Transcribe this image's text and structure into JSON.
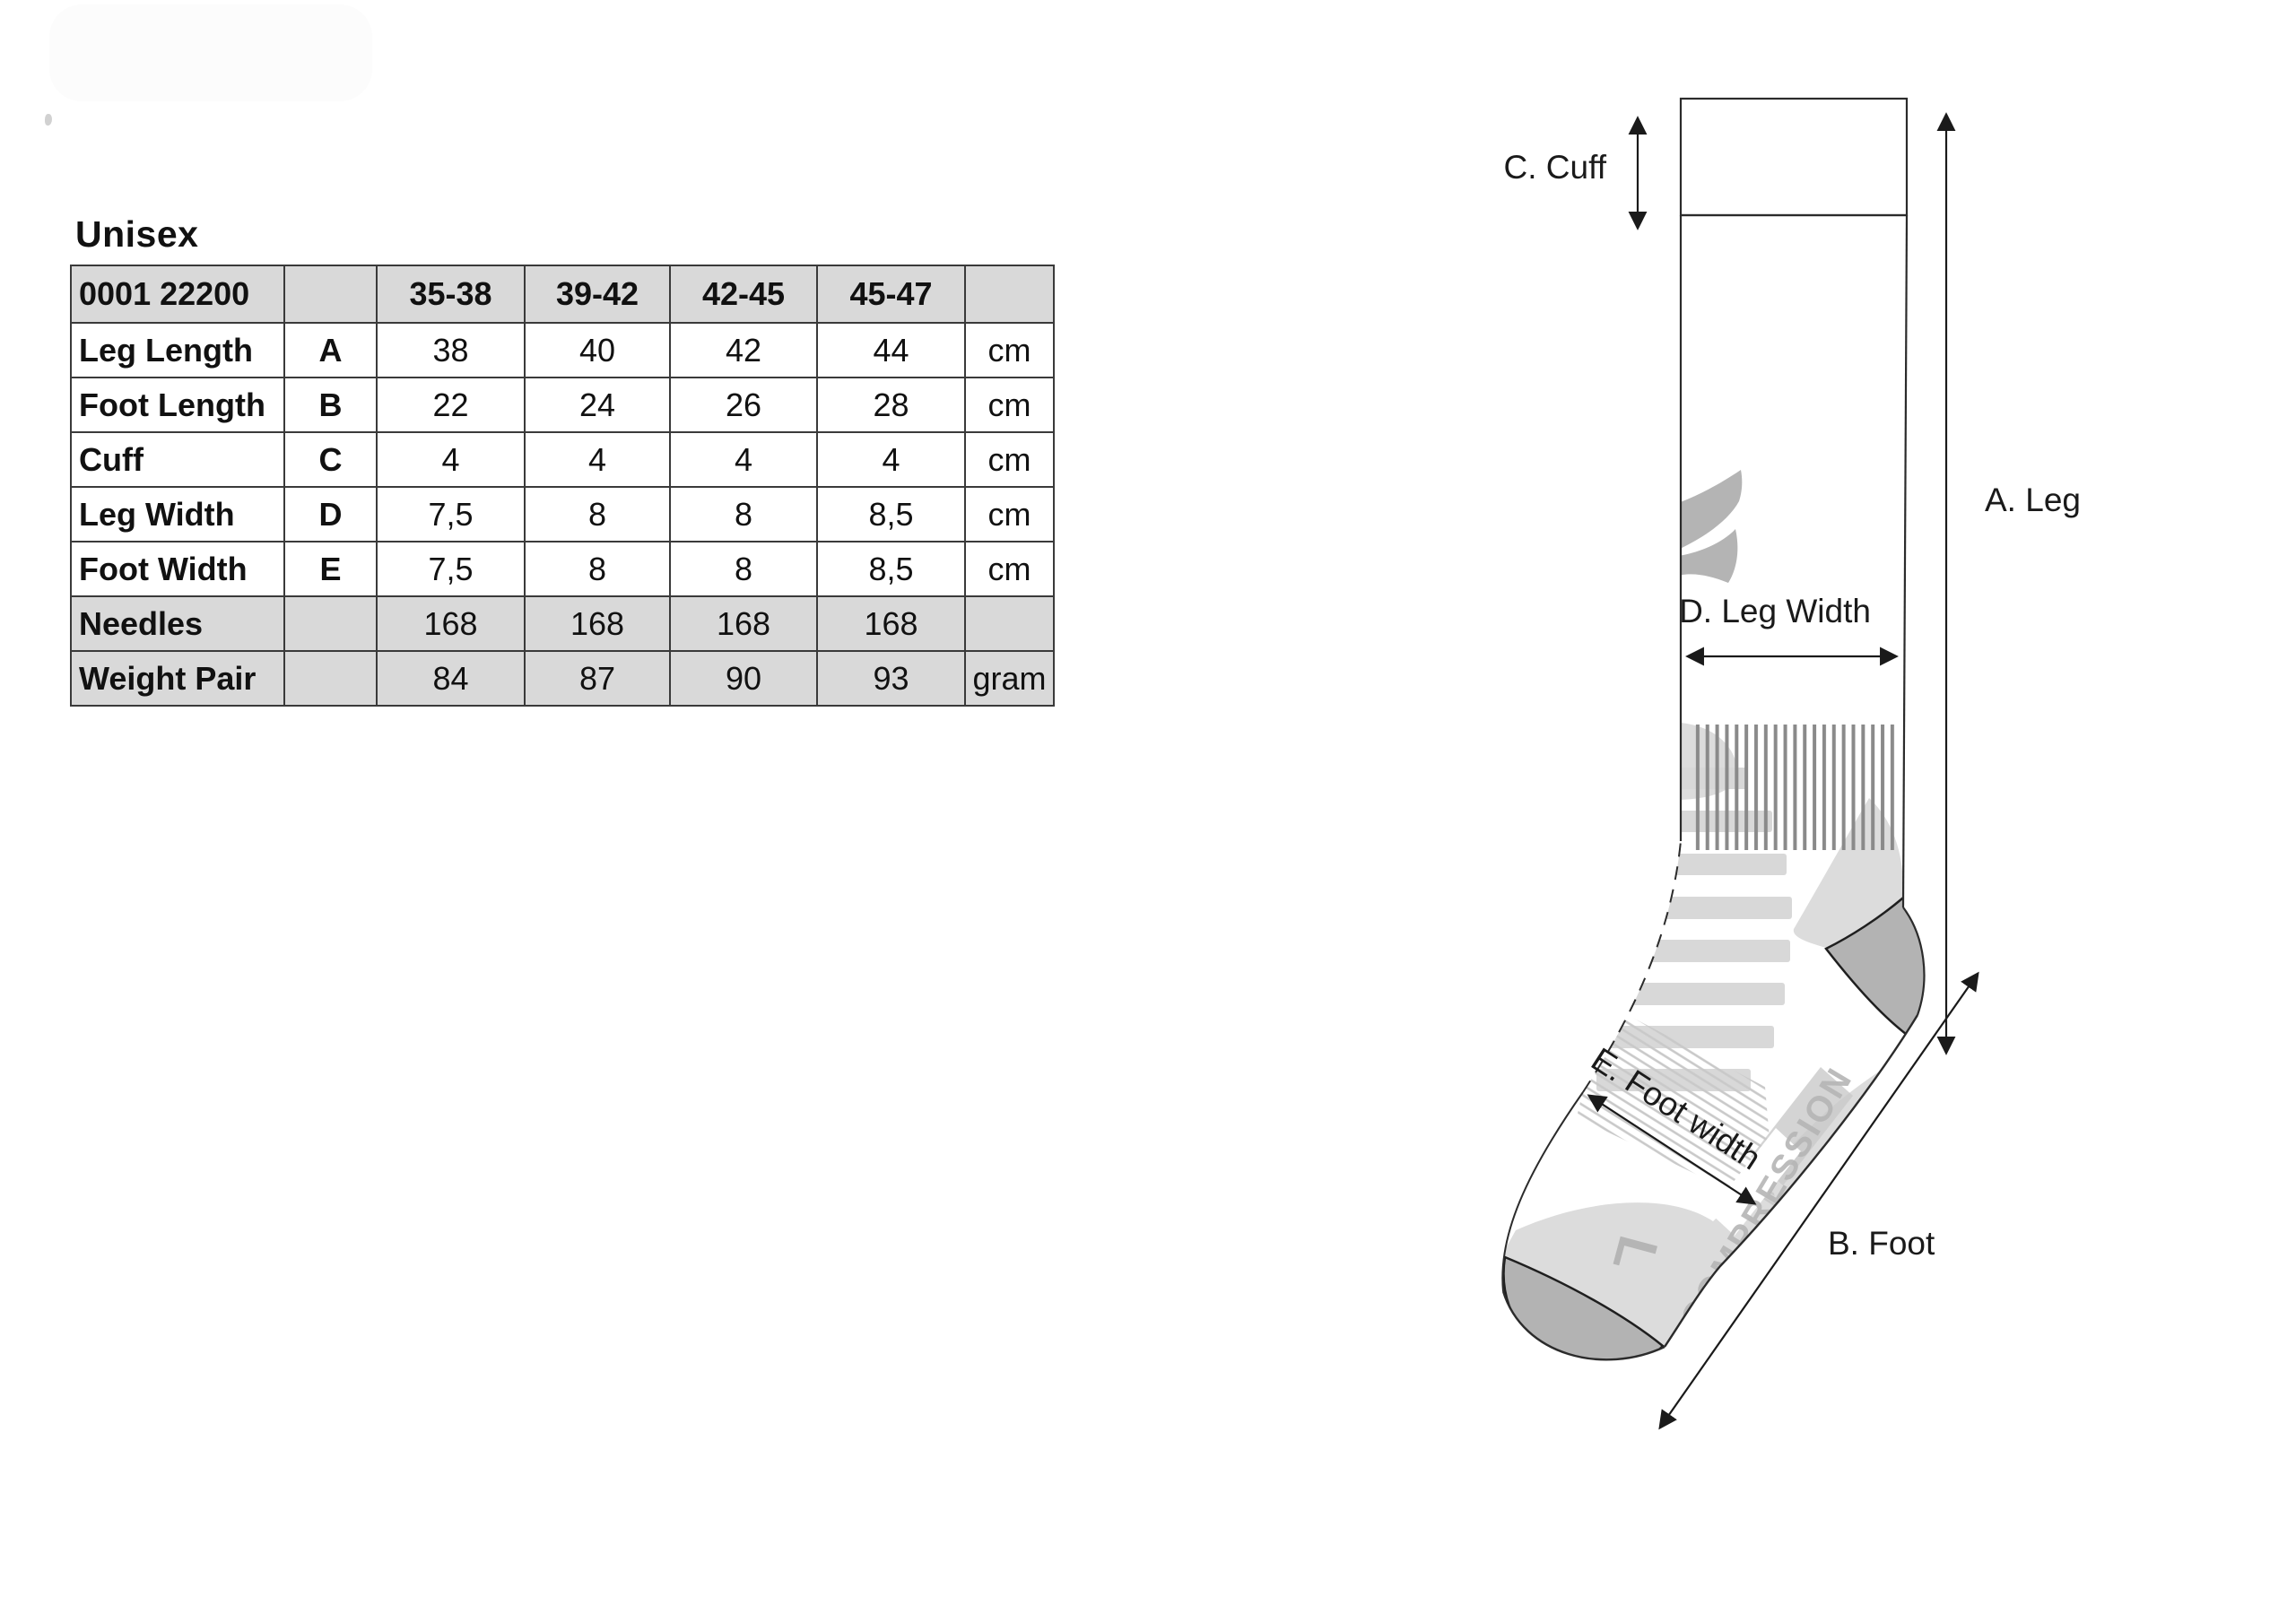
{
  "title": "Unisex",
  "table": {
    "header": [
      "0001 22200",
      "",
      "35-38",
      "39-42",
      "42-45",
      "45-47",
      ""
    ],
    "rows": [
      {
        "label": "Leg Length",
        "letter": "A",
        "values": [
          "38",
          "40",
          "42",
          "44"
        ],
        "unit": "cm",
        "shaded": false
      },
      {
        "label": "Foot Length",
        "letter": "B",
        "values": [
          "22",
          "24",
          "26",
          "28"
        ],
        "unit": "cm",
        "shaded": false
      },
      {
        "label": "Cuff",
        "letter": "C",
        "values": [
          "4",
          "4",
          "4",
          "4"
        ],
        "unit": "cm",
        "shaded": false
      },
      {
        "label": "Leg Width",
        "letter": "D",
        "values": [
          "7,5",
          "8",
          "8",
          "8,5"
        ],
        "unit": "cm",
        "shaded": false
      },
      {
        "label": "Foot Width",
        "letter": "E",
        "values": [
          "7,5",
          "8",
          "8",
          "8,5"
        ],
        "unit": "cm",
        "shaded": false
      },
      {
        "label": "Needles",
        "letter": "",
        "values": [
          "168",
          "168",
          "168",
          "168"
        ],
        "unit": "",
        "shaded": true
      },
      {
        "label": "Weight Pair",
        "letter": "",
        "values": [
          "84",
          "87",
          "90",
          "93"
        ],
        "unit": "gram",
        "shaded": true
      }
    ]
  },
  "diagram": {
    "labels": {
      "leg": "A. Leg",
      "foot": "B. Foot",
      "cuff": "C. Cuff",
      "leg_width": "D. Leg Width",
      "foot_width": "E. Foot width"
    },
    "sock_text": {
      "compression": "COMPRESSION",
      "size_marker": "L"
    }
  },
  "colors": {
    "text": "#111111",
    "table_border": "#3a3a3a",
    "table_shade": "#d9d9d9",
    "outline": "#2b2b2b",
    "rib_stripe": "#8a8a8a",
    "cuff_stripe": "#a3a3a3",
    "shade_light": "#dcdcdc",
    "stripe_bar": "#d8d8d8",
    "heel_toe": "#b3b3b3",
    "logo": "#b4b4b4",
    "soft_text": "#b5b5b5",
    "hatch": "#c9c9c9",
    "label_text": "#1a1a1a"
  }
}
